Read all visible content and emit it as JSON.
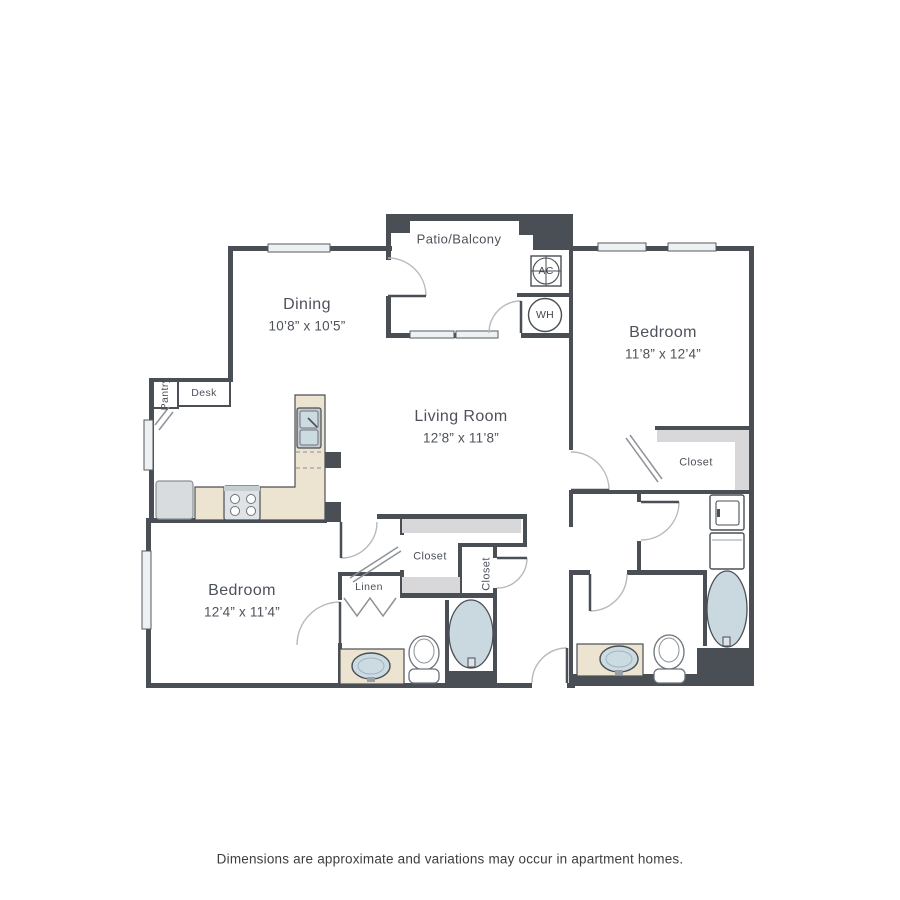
{
  "disclaimer": "Dimensions are approximate and variations may occur in apartment homes.",
  "rooms": {
    "patio": {
      "name": "Patio/Balcony"
    },
    "dining": {
      "name": "Dining",
      "dims": "10’8” x 10’5”"
    },
    "living": {
      "name": "Living Room",
      "dims": "12’8” x 11’8”"
    },
    "bedroom2": {
      "name": "Bedroom",
      "dims": "11’8” x 12’4”"
    },
    "bedroom1": {
      "name": "Bedroom",
      "dims": "12’4” x 11’4”"
    }
  },
  "labels": {
    "closet_walkin": "Closet",
    "closet_foyer": "Closet",
    "closet_bedroom2": "Closet",
    "linen": "Linen",
    "desk": "Desk",
    "pantry": "Pantry",
    "ac": "AC",
    "wh": "WH"
  },
  "colors": {
    "wall": "#4a4e55",
    "counter": "#ece4d0",
    "water_fixture": "#ccdbe2",
    "tub": "#c9d9df",
    "shelf": "#d8d8da",
    "window": "#eef1f2",
    "appliance": "#dbdfe2",
    "door_arc": "#b6babe",
    "label_text": "#4d525a"
  }
}
